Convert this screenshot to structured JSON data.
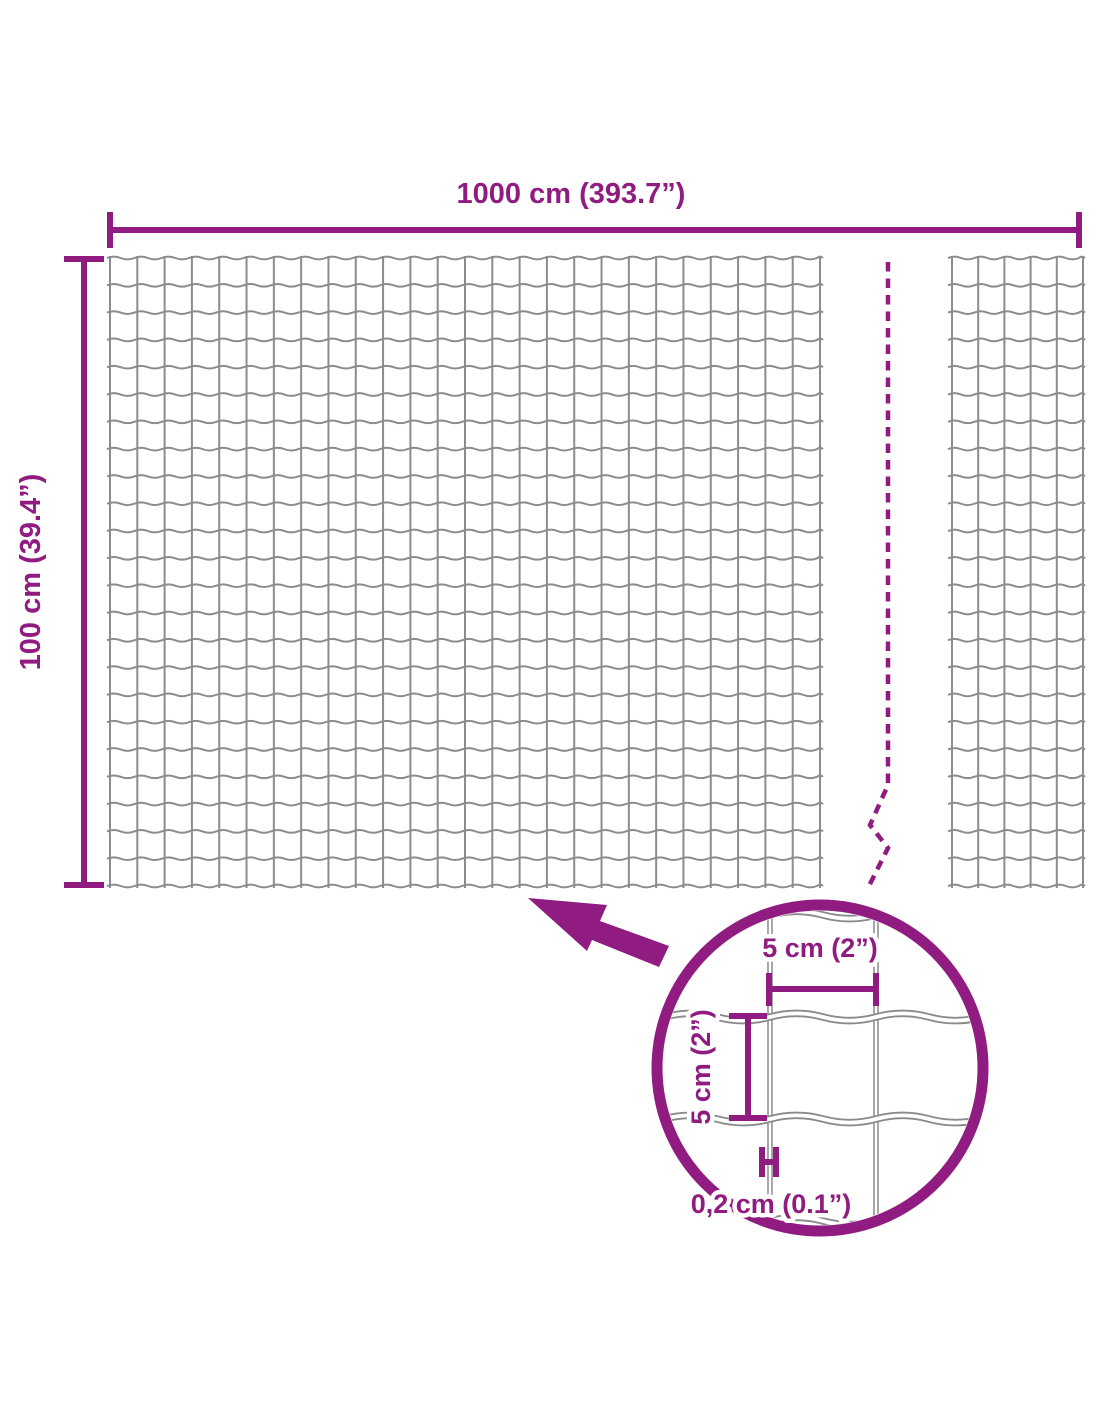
{
  "colors": {
    "accent": "#911C81",
    "wire": "#8C8C8C"
  },
  "overall_dimensions": {
    "width_label": "1000 cm (393.7”)",
    "height_label": "100 cm (39.4”)"
  },
  "mesh_detail": {
    "cell_width_label": "5 cm (2”)",
    "cell_height_label": "5 cm (2”)",
    "wire_thickness_label": "0,2 cm (0.1”)"
  }
}
